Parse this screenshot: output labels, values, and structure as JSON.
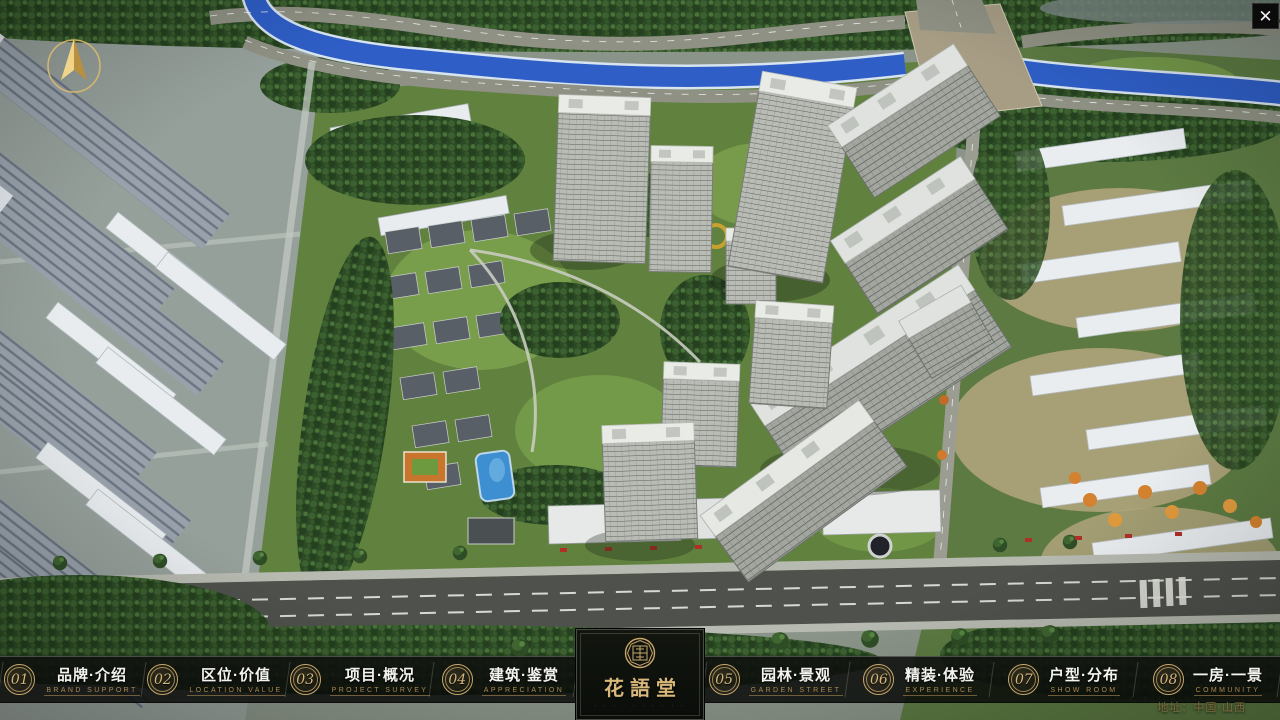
{
  "brand": {
    "name": "花語堂",
    "caption": "· · · · · · · · · ·"
  },
  "nav": {
    "items": [
      {
        "number": "01",
        "title": "品牌·介绍",
        "subtitle": "BRAND SUPPORT"
      },
      {
        "number": "02",
        "title": "区位·价值",
        "subtitle": "LOCATION VALUE"
      },
      {
        "number": "03",
        "title": "项目·概况",
        "subtitle": "PROJECT SURVEY"
      },
      {
        "number": "04",
        "title": "建筑·鉴赏",
        "subtitle": "APPRECIATION"
      },
      {
        "number": "05",
        "title": "园林·景观",
        "subtitle": "GARDEN STREET"
      },
      {
        "number": "06",
        "title": "精装·体验",
        "subtitle": "EXPERIENCE"
      },
      {
        "number": "07",
        "title": "户型·分布",
        "subtitle": "SHOW ROOM"
      },
      {
        "number": "08",
        "title": "一房·一景",
        "subtitle": "COMMUNITY"
      }
    ]
  },
  "footer": {
    "address": "地址：中国·山西"
  },
  "icons": {
    "close_glyph": "✕",
    "compass": "gold-north-arrow-in-ring",
    "seal": "octagonal-gold-seal"
  },
  "palette": {
    "gold": "#C9A76A",
    "gold_text": "#D6B77C",
    "subtitle_gold": "#AB8951",
    "navbar_bg": "#0A0C0A",
    "river_blue": "#2E5EC6",
    "title_white": "#F3F3EF"
  }
}
